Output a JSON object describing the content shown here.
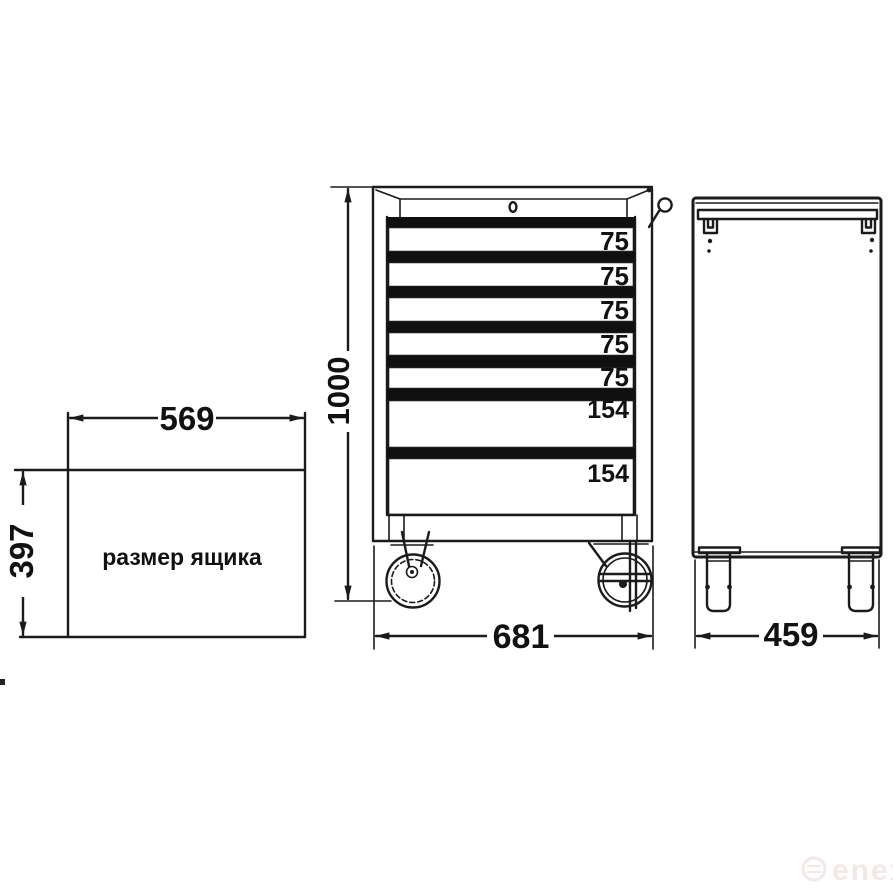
{
  "drawer_box": {
    "caption": "размер ящика",
    "width_mm": "569",
    "height_mm": "397"
  },
  "front_view": {
    "height_mm": "1000",
    "width_mm": "681",
    "drawer_heights": [
      "75",
      "75",
      "75",
      "75",
      "75",
      "154",
      "154"
    ]
  },
  "side_view": {
    "depth_mm": "459"
  },
  "watermark": {
    "text": "enex"
  },
  "colors": {
    "line": "#1b1b1b",
    "drawer_handle": "#101010",
    "background": "#ffffff",
    "watermark": "#f3e7e7"
  }
}
